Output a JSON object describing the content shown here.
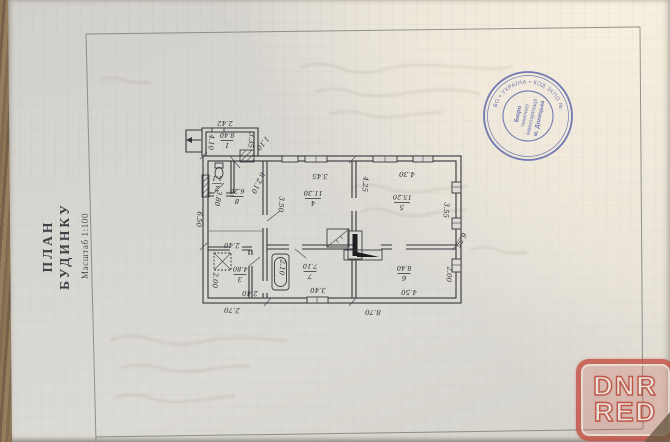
{
  "title_block": {
    "line1": "ПЛАН",
    "line2": "БУДИНКУ",
    "scale": "Масштаб 1:100"
  },
  "watermark": {
    "line1": "DNR",
    "line2": "RED",
    "color": "#c34638"
  },
  "stamp": {
    "color": "#5560a8",
    "ring_text": "• КОМУНАЛЬНЕ ПІДПРИЄМСТВО • УКРАЇНА • КОД ЗКПО №",
    "center_lines": [
      "Бюро",
      "технічної",
      "інвентаризації",
      "м. Донецька"
    ]
  },
  "plan": {
    "scale_note": "1:100",
    "rooms": [
      {
        "num": "1",
        "area": "8.40",
        "x": 227,
        "y": 141,
        "r": 181
      },
      {
        "num": "2",
        "area": "1.1",
        "x": 217,
        "y": 184,
        "r": 181
      },
      {
        "num": "8",
        "area": "6.20",
        "x": 237,
        "y": 197,
        "r": 181
      },
      {
        "num": "3",
        "area": "4.80",
        "x": 240,
        "y": 275,
        "r": 182
      },
      {
        "num": "4",
        "area": "11.30",
        "x": 313,
        "y": 199,
        "r": 181
      },
      {
        "num": "5",
        "area": "15.20",
        "x": 402,
        "y": 203,
        "r": 182
      },
      {
        "num": "7",
        "area": "7.10",
        "x": 310,
        "y": 272,
        "r": 181
      },
      {
        "num": "6",
        "area": "8.40",
        "x": 404,
        "y": 274,
        "r": 181
      }
    ],
    "dims": [
      {
        "text": "2.42",
        "x": 225,
        "y": 121,
        "r": 181
      },
      {
        "text": "4.10",
        "x": 209,
        "y": 142,
        "r": 95
      },
      {
        "text": "3.35",
        "x": 249,
        "y": 140,
        "r": 95
      },
      {
        "text": "1.10",
        "x": 261,
        "y": 142,
        "r": 130
      },
      {
        "text": "h 2.10",
        "x": 256,
        "y": 182,
        "r": 115
      },
      {
        "text": "3.80",
        "x": 216,
        "y": 198,
        "r": 100
      },
      {
        "text": "6.50",
        "x": 197,
        "y": 219,
        "r": 95
      },
      {
        "text": "2.40",
        "x": 232,
        "y": 243,
        "r": 182
      },
      {
        "text": "2.00",
        "x": 213,
        "y": 280,
        "r": 95
      },
      {
        "text": "2.40",
        "x": 250,
        "y": 291,
        "r": 182
      },
      {
        "text": "2.70",
        "x": 232,
        "y": 308,
        "r": 183
      },
      {
        "text": "3.50",
        "x": 279,
        "y": 204,
        "r": 95
      },
      {
        "text": "3.45",
        "x": 320,
        "y": 174,
        "r": 181
      },
      {
        "text": "4.25",
        "x": 363,
        "y": 184,
        "r": 95
      },
      {
        "text": "4.30",
        "x": 407,
        "y": 172,
        "r": 182
      },
      {
        "text": "3.55",
        "x": 444,
        "y": 210,
        "r": 95
      },
      {
        "text": "6.55",
        "x": 459,
        "y": 239,
        "r": 120
      },
      {
        "text": "2.00",
        "x": 447,
        "y": 274,
        "r": 95
      },
      {
        "text": "4.50",
        "x": 409,
        "y": 290,
        "r": 181
      },
      {
        "text": "3.40",
        "x": 318,
        "y": 288,
        "r": 181
      },
      {
        "text": "2.10",
        "x": 280,
        "y": 267,
        "r": 95
      },
      {
        "text": "8.70",
        "x": 373,
        "y": 310,
        "r": 182
      }
    ]
  }
}
